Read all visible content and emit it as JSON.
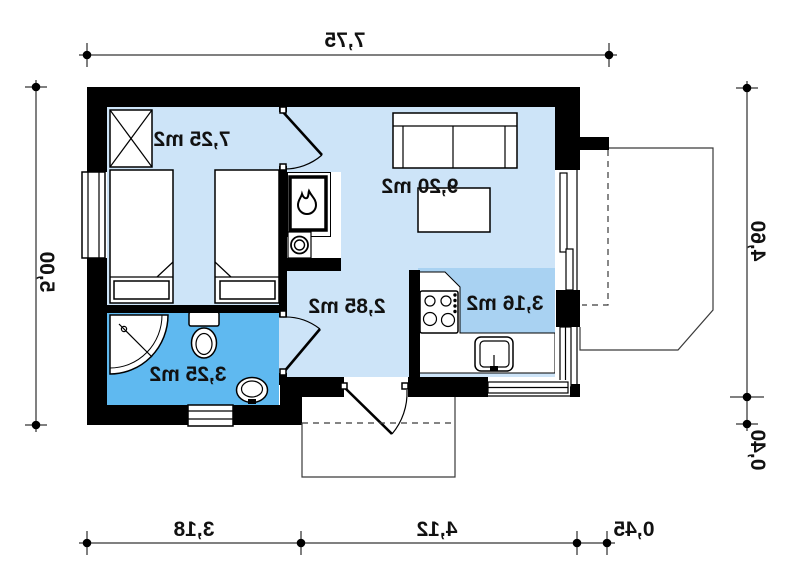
{
  "plan": {
    "type": "house-floor-plan-mirrored",
    "rooms": {
      "bedroom": {
        "area_label": "7,25 m2"
      },
      "living": {
        "area_label": "9,20 m2"
      },
      "hall": {
        "area_label": "2,85 m2"
      },
      "kitchen": {
        "area_label": "3,16 m2"
      },
      "bathroom": {
        "area_label": "3,25 m2"
      }
    },
    "dimensions": {
      "top_width": "7,75",
      "left_depth": "5,00",
      "right_depth_main": "4,60",
      "right_depth_offset": "0,40",
      "bottom_left": "3,18",
      "bottom_center": "4,12",
      "bottom_right": "0,45"
    },
    "icons": {
      "stove": "flame-icon",
      "wardrobe": "crossed-box-icon"
    },
    "colors": {
      "room_light_blue": "#cde4f8",
      "kitchen_blue": "#a9d2f2",
      "bathroom_blue": "#5fb9f0",
      "wall_black": "#000000",
      "background": "#ffffff"
    }
  }
}
